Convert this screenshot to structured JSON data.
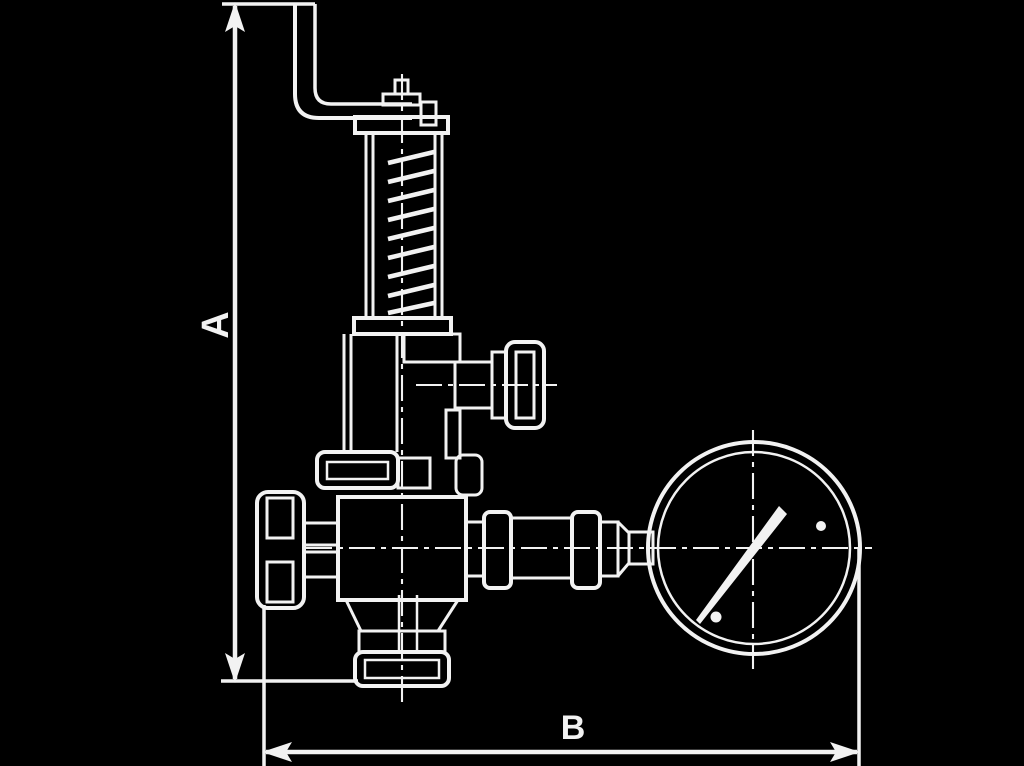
{
  "drawing": {
    "colors": {
      "background": "#000000",
      "line": "#f2f2f2"
    },
    "dimension_a": {
      "label": "A"
    },
    "dimension_b": {
      "label": "B"
    },
    "parts": [
      "lever-arm",
      "top-stem-and-nut",
      "spring-housing",
      "spring-coils",
      "side-outlet-handwheel",
      "bonnet-union-nut",
      "inlet-handwheel",
      "valve-body",
      "bottom-outlet-flange",
      "pipe-union-fittings",
      "pressure-gauge",
      "gauge-needle"
    ]
  }
}
